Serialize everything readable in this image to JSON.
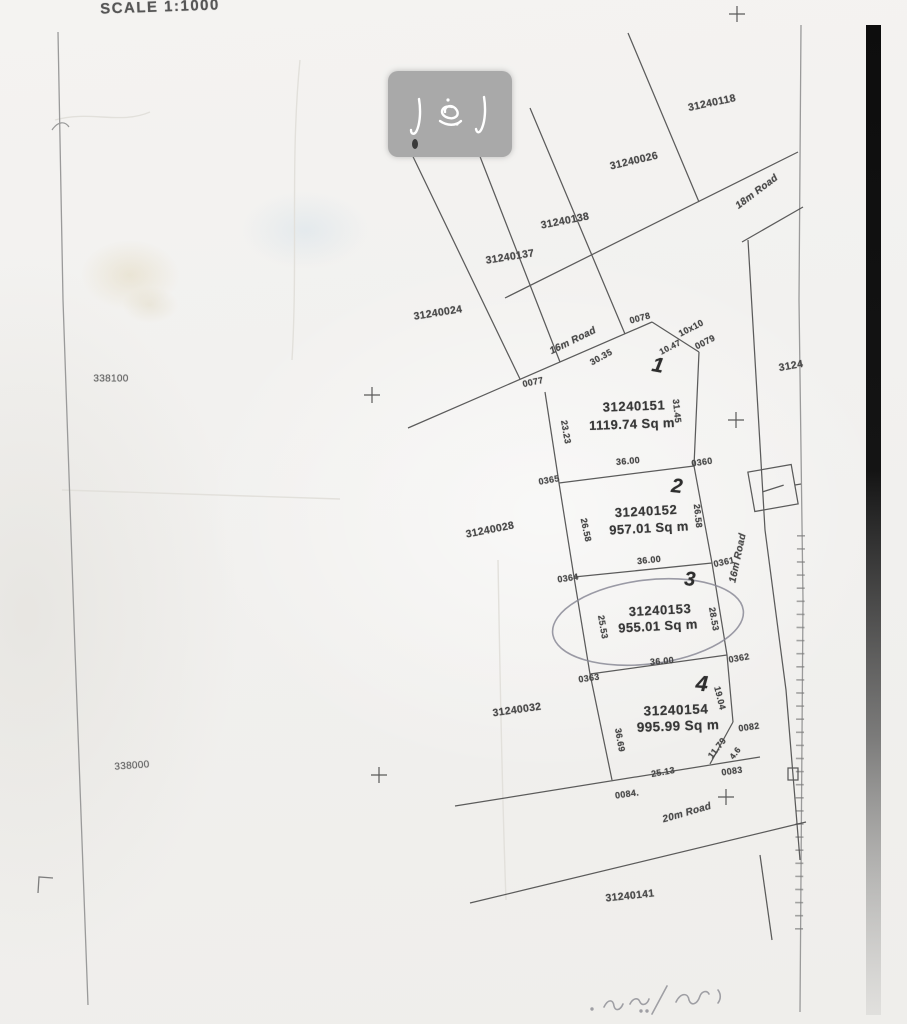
{
  "map": {
    "scale_label": "SCALE 1:1000",
    "northing_top": "338100",
    "northing_bottom": "338000",
    "roads": {
      "r18": "18m Road",
      "r16_upper": "16m Road",
      "r16_right": "16m Road",
      "r20": "20m Road"
    },
    "plots": {
      "p1": {
        "no": "1",
        "parcel": "31240151",
        "area": "1119.74 Sq m"
      },
      "p2": {
        "no": "2",
        "parcel": "31240152",
        "area": "957.01 Sq m"
      },
      "p3": {
        "no": "3",
        "parcel": "31240153",
        "area": "955.01 Sq m"
      },
      "p4": {
        "no": "4",
        "parcel": "31240154",
        "area": "995.99 Sq m"
      }
    },
    "neighbors": {
      "n118": "31240118",
      "n026": "31240026",
      "n138": "31240138",
      "n137": "31240137",
      "n024": "31240024",
      "n028": "31240028",
      "n032": "31240032",
      "n141": "31240141",
      "n_right_clipped": "3124"
    },
    "corners": {
      "c0077": "0077",
      "c0078": "0078",
      "c0079": "0079",
      "c0360": "0360",
      "c0361": "0361",
      "c0362": "0362",
      "c0363": "0363",
      "c0364": "0364",
      "c0365": "0365",
      "c0082": "0082",
      "c0083": "0083",
      "c0084": "0084."
    },
    "dims": {
      "d3035": "30.35",
      "d10x10": "10x10",
      "d1047": "10.47",
      "d3145": "31.45",
      "d2323": "23.23",
      "d3600_1": "36.00",
      "d2658_l": "26.58",
      "d2658_r": "26.58",
      "d3600_2": "36.00",
      "d2553": "25.53",
      "d2853": "28.53",
      "d3600_3": "36.00",
      "d3669": "36.69",
      "d1904": "19.04",
      "d1179": "11.79",
      "d46": "4.6",
      "d2513": "25.13"
    }
  }
}
